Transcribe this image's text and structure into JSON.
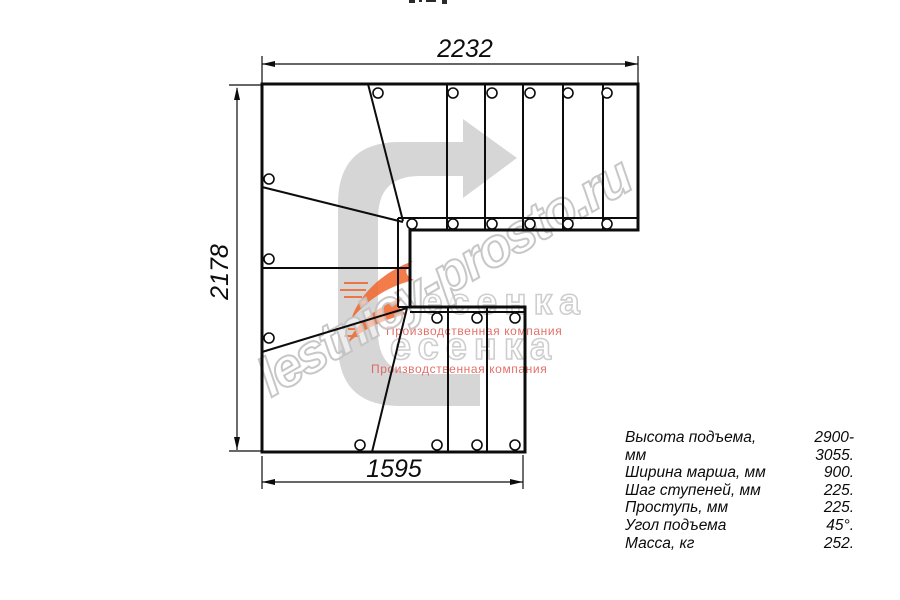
{
  "drawing_title": "staircase-plan-top-view",
  "dimensions": {
    "top": "2232",
    "left": "2178",
    "bottom": "1595"
  },
  "specs": {
    "rows": [
      {
        "label": "Высота подъема, мм",
        "value": "2900-3055."
      },
      {
        "label": "Ширина марша, мм",
        "value": "900."
      },
      {
        "label": "Шаг ступеней, мм",
        "value": "225."
      },
      {
        "label": "Проступь, мм",
        "value": "225."
      },
      {
        "label": "Угол подъема",
        "value": "45°."
      },
      {
        "label": "Масса, кг",
        "value": "252."
      }
    ]
  },
  "watermark": {
    "site": "lestnicy-prosto.ru",
    "logo_text": "есенка",
    "logo_caption": "Производственная компания"
  },
  "icons": {
    "direction_arrow": "u-turn-right-direction-arrow",
    "mounting_hole": "screw-hole-circle"
  },
  "colors": {
    "background": "#ffffff",
    "line": "#0c0c0c",
    "arrow_fill": "#d6d6d6",
    "watermark_stroke": "#c1c1c1",
    "watermark_red": "#e0564c",
    "logo_orange": "#f1662b"
  }
}
